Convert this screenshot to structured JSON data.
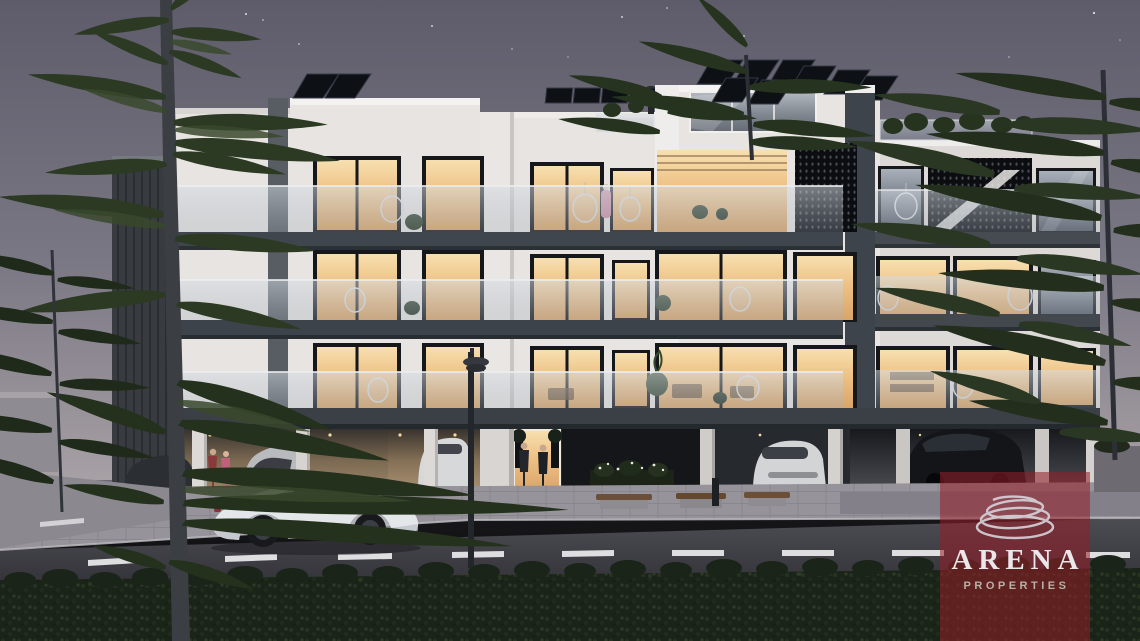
{
  "watermark": {
    "brand": "ARENA",
    "subtitle": "PROPERTIES",
    "icon": "swirl-logo-icon",
    "panel_color": "#981e28",
    "brand_text_color": "#e9e7ea",
    "subtitle_text_color": "#b7b2a6"
  },
  "scene": {
    "type": "architectural-render",
    "time_of_day": "dusk",
    "subject": "modern three-storey apartment building with rooftop solar panels, glass balconies, ground-floor parking, street, hedge and pine trees",
    "palette": {
      "sky_top": "#5e5c6a",
      "sky_horizon": "#a7a0a5",
      "facade_white": "#e8e5e2",
      "balcony_slab": "#3d444b",
      "window_glow": "#eec185",
      "perforated_screen": "#0c0e11",
      "road_asphalt": "#3f3f46",
      "lane_marking": "#ecebee",
      "hedge_green": "#1b2418",
      "tree_green": "#2c3a24",
      "feature_car_white": "#e4e7ea"
    }
  }
}
